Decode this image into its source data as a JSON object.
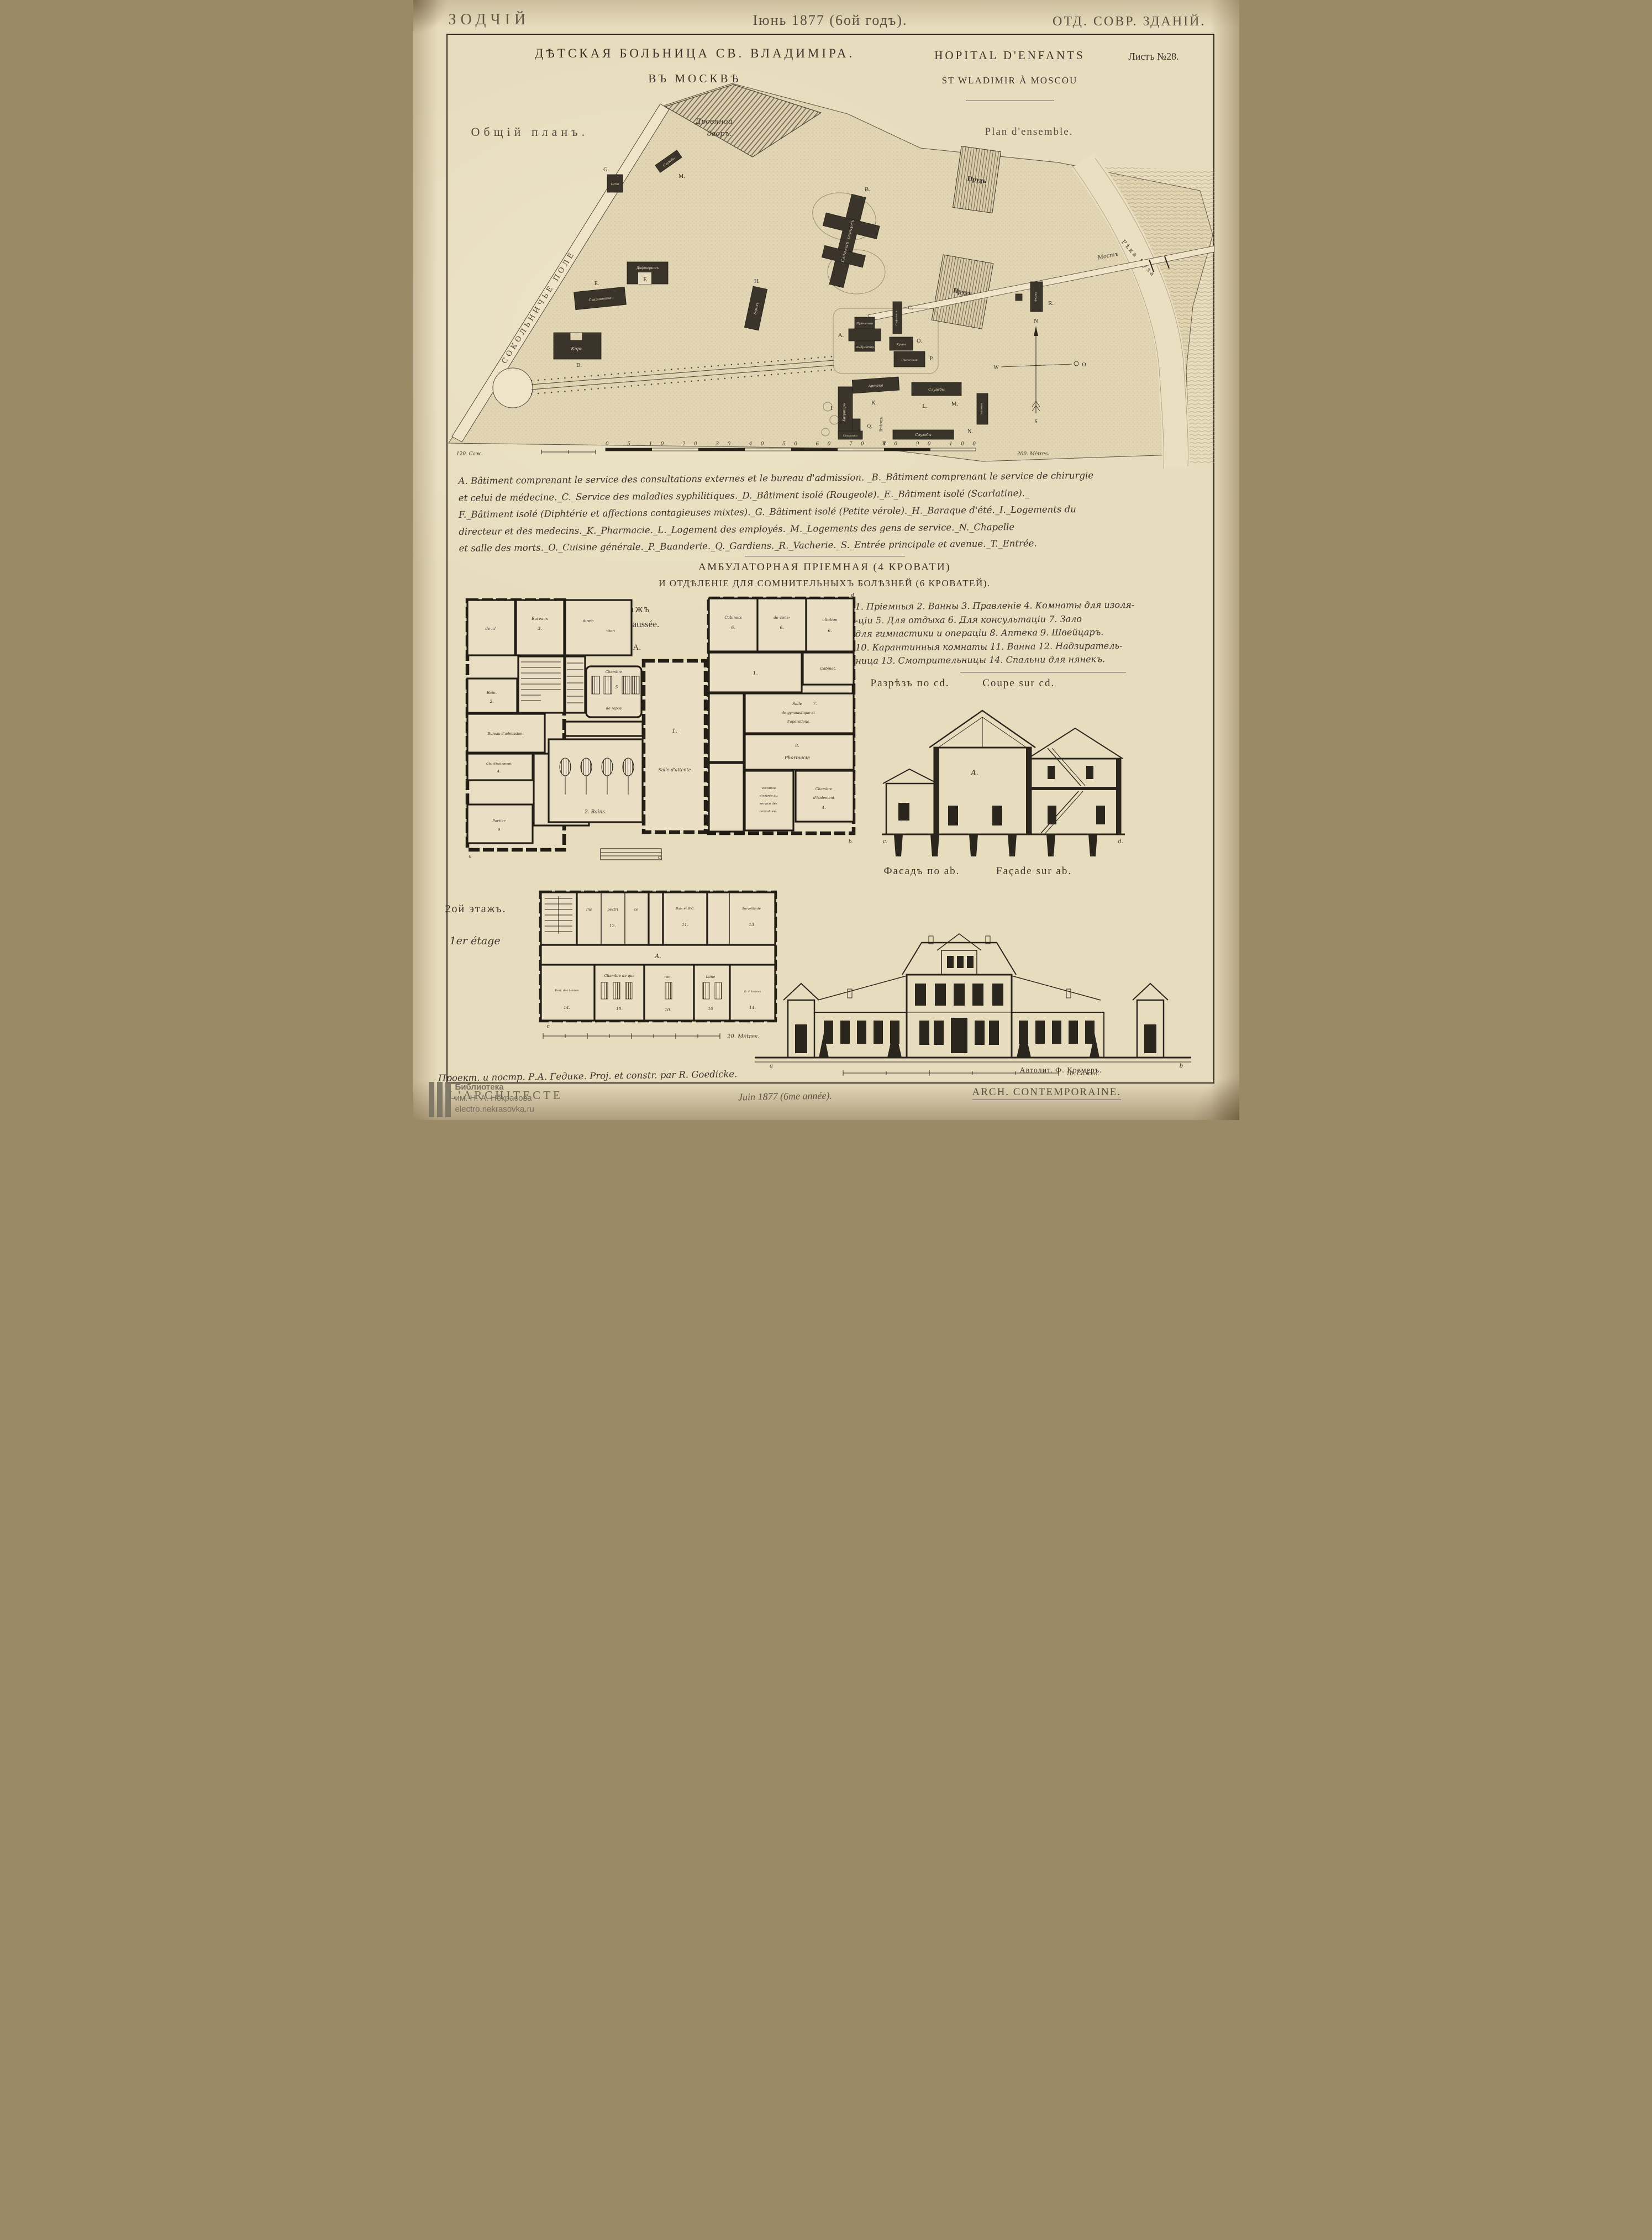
{
  "header": {
    "journal": "ЗОДЧІЙ",
    "issue": "Іюнь 1877 (6ой годъ).",
    "section": "ОТД. СОВР. ЗДАНІЙ."
  },
  "title": {
    "ru_line1": "ДѢТСКАЯ БОЛЬНИЦА СВ. ВЛАДИМІРА.",
    "ru_line2": "ВЪ МОСКВѢ",
    "fr_line1": "HOPITAL D'ENFANTS",
    "fr_line2": "ST WLADIMIR À MOSCOU",
    "sheet_no": "Листъ №28."
  },
  "site": {
    "caption_ru": "Общій планъ.",
    "caption_fr": "Plan d'ensemble.",
    "field": "СОКОЛЬНИЧЬЕ ПОЛЕ",
    "wood_yard_1": "Дровяной",
    "wood_yard_2": "дворъ.",
    "sluzhby_top": "Службы",
    "letter_m_top": "М.",
    "letter_g": "G.",
    "ospa": "Оспа",
    "diphtherite": "Дифтеритъ",
    "letter_f": "F.",
    "letter_e": "Е.",
    "scarlatine": "Скарлатина",
    "kor": "Корь.",
    "letter_d": "D.",
    "letter_h": "Н.",
    "barak": "Баракъ",
    "letter_b": "В.",
    "main_building": "Главный корпусъ",
    "pond1": "Прудъ",
    "pond2": "Прудъ",
    "bridge": "Мостъ",
    "river": "Рѣка Яуза",
    "ferma": "Ферма",
    "letter_r": "R.",
    "letter_a": "А.",
    "priemnaya": "Пріемная",
    "ambulatoria": "Амбулатор.",
    "letter_c": "С.",
    "syphilis": "Сифилисъ",
    "kitchen": "Кухня",
    "letter_o": "О.",
    "laundry": "Прачечная",
    "letter_p": "Р.",
    "apteka": "Аптека",
    "letter_k": "К.",
    "sluzhby_mid": "Службы",
    "letter_l": "L.",
    "letter_m2": "М.",
    "kvartiry": "Квартиры",
    "letter_i": "I.",
    "letter_q": "Q.",
    "vjezd": "Въѣздъ",
    "letter_t": "Т.",
    "storozh": "Сторожъ",
    "sluzhby_bottom": "Службы",
    "chapel": "Часовня",
    "letter_n": "N.",
    "compass": {
      "n": "N",
      "s": "S",
      "w": "W",
      "o": "O"
    },
    "scale_sazh": "120. Саж.",
    "scale_ticks": "0 5 10 20 30 40 50 60 70 80 90 100",
    "scale_m": "200. Mètres."
  },
  "legend_fr": {
    "line1": "A. Bâtiment comprenant le service des consultations externes et le bureau d'admission. _B._Bâtiment comprenant le service de chirurgie",
    "line2": "et celui de médecine._C._Service des maladies syphilitiques._D._Bâtiment isolé (Rougeole)._E._Bâtiment isolé (Scarlatine)._",
    "line3": "F._Bâtiment isolé (Diphtérie et affections contagieuses mixtes)._G._Bâtiment isolé (Petite vérole)._H._Baraque d'été._I._Logements du",
    "line4": "directeur et des medecins._K._Pharmacie._L._Logement des employés._M._Logements des gens de service._N._Chapelle",
    "line5": "et salle des morts._O._Cuisine générale._P._Buanderie._Q._Gardiens._R._Vacherie._S._Entrée principale et avenue._T._Entrée."
  },
  "ward_title": {
    "line1": "АМБУЛАТОРНАЯ ПРІЕМНАЯ (4 КРОВАТИ)",
    "line2": "И ОТДѢЛЕНІЕ ДЛЯ СОМНИТЕЛЬНЫХЪ БОЛѢЗНЕЙ (6 КРОВАТЕЙ)."
  },
  "legend_ru": {
    "line1": "1. Пріемныя  2. Ванны  3. Правленіе  4. Комнаты для изоля-",
    "line2": "-ціи  5. Для отдыха  6. Для консультаціи  7. Зало",
    "line3": "для гимнастики и операціи  8. Аптека  9. Швейцаръ.",
    "line4": "10. Карантинныя комнаты  11. Ванна  12. Надзиратель-",
    "line5": "ница  13. Смотрительницы  14. Спальни для нянекъ."
  },
  "floor1": {
    "caption_ru": "1й этажъ",
    "caption_fr": "Rez de chaussée.",
    "block_letter": "А.",
    "de_la": "de la'",
    "bureaux": "Bureaux",
    "num3": "3.",
    "direc": "direc-",
    "tion": "-tion",
    "bain": "Bain.",
    "num2": "2.",
    "admission": "Bureau d'admission.",
    "ch_isolement": "Ch. d'isolement",
    "num4": "4.",
    "vest1_1": "Vestibule",
    "vest1_2": "d'entrée au",
    "vest1_3": "bureau",
    "vest1_4": "d'admission",
    "portier": "Portier",
    "num9": "9",
    "chambre": "Chambre",
    "num5": "5",
    "de_repos": "de repos",
    "bains": "2. Bains.",
    "num1_hall": "1.",
    "salle_attente": "Salle d'attente",
    "cabinets": "Cabinets",
    "num6a": "6.",
    "de_cons": "de cons-",
    "num6b": "6.",
    "ultation": "ultation",
    "num6c": "6.",
    "num1_room": "1.",
    "cabinet": "Cabinet.",
    "salle": "Salle",
    "num7": "7.",
    "gym": "de gymnastique et",
    "operations": "d'opérations.",
    "num8": "8.",
    "pharmacie": "Pharmacie",
    "vest2_1": "Vestibule",
    "vest2_2": "d'entrée au",
    "vest2_3": "service des",
    "vest2_4": "consul. ext.",
    "chambre2": "Chambre",
    "isolement2": "d'isolement",
    "num4b": "4.",
    "corner_a": "a",
    "corner_b": "b.",
    "corner_c": "c.",
    "corner_d": "d"
  },
  "section_dwg": {
    "caption_ru": "Разрѣзъ по cd.",
    "caption_fr": "Coupe sur cd.",
    "block_letter": "А.",
    "corner_c": "c.",
    "corner_d": "d."
  },
  "facade": {
    "caption_ru": "Фасадъ по ab.",
    "caption_fr": "Façade sur ab.",
    "corner_a": "a",
    "corner_b": "b",
    "scale": "10. Сажен."
  },
  "floor2": {
    "caption_ru": "2ой этажъ.",
    "caption_fr": "1er étage",
    "ins": "Ins",
    "pectri": "pectri",
    "ce": "ce",
    "num12": "12.",
    "bain_wc": "Bain et W.C.",
    "num11": "11.",
    "surveillante": "Surveillante",
    "num13": "13",
    "corridor": "A.",
    "dort_bonnes": "Dort. des bonnes",
    "num14a": "14.",
    "chambre_qua": "Chambre de qua",
    "ran": "ran-",
    "taine": "taine",
    "num10a": "10.",
    "num10b": "10.",
    "num10c": "10",
    "d_bonnes": "D. d. bonnes",
    "num14b": "14.",
    "corner_c": "c",
    "scale": "20. Mètres."
  },
  "footer": {
    "credit": "Проект. и постр. Р.А. Гедике.  Proj. et constr. par R. Goedicke.",
    "lith": "Автолит. Ф. Кремеръ.",
    "journal": "L'ARCHITECTE",
    "date": "Juin 1877 (6me année).",
    "series": "ARCH. CONTEMPORAINE."
  },
  "watermark": {
    "line1": "Библиотека",
    "line2": "им. Н. А. Некрасова",
    "line3": "electro.nekrasovka.ru"
  }
}
